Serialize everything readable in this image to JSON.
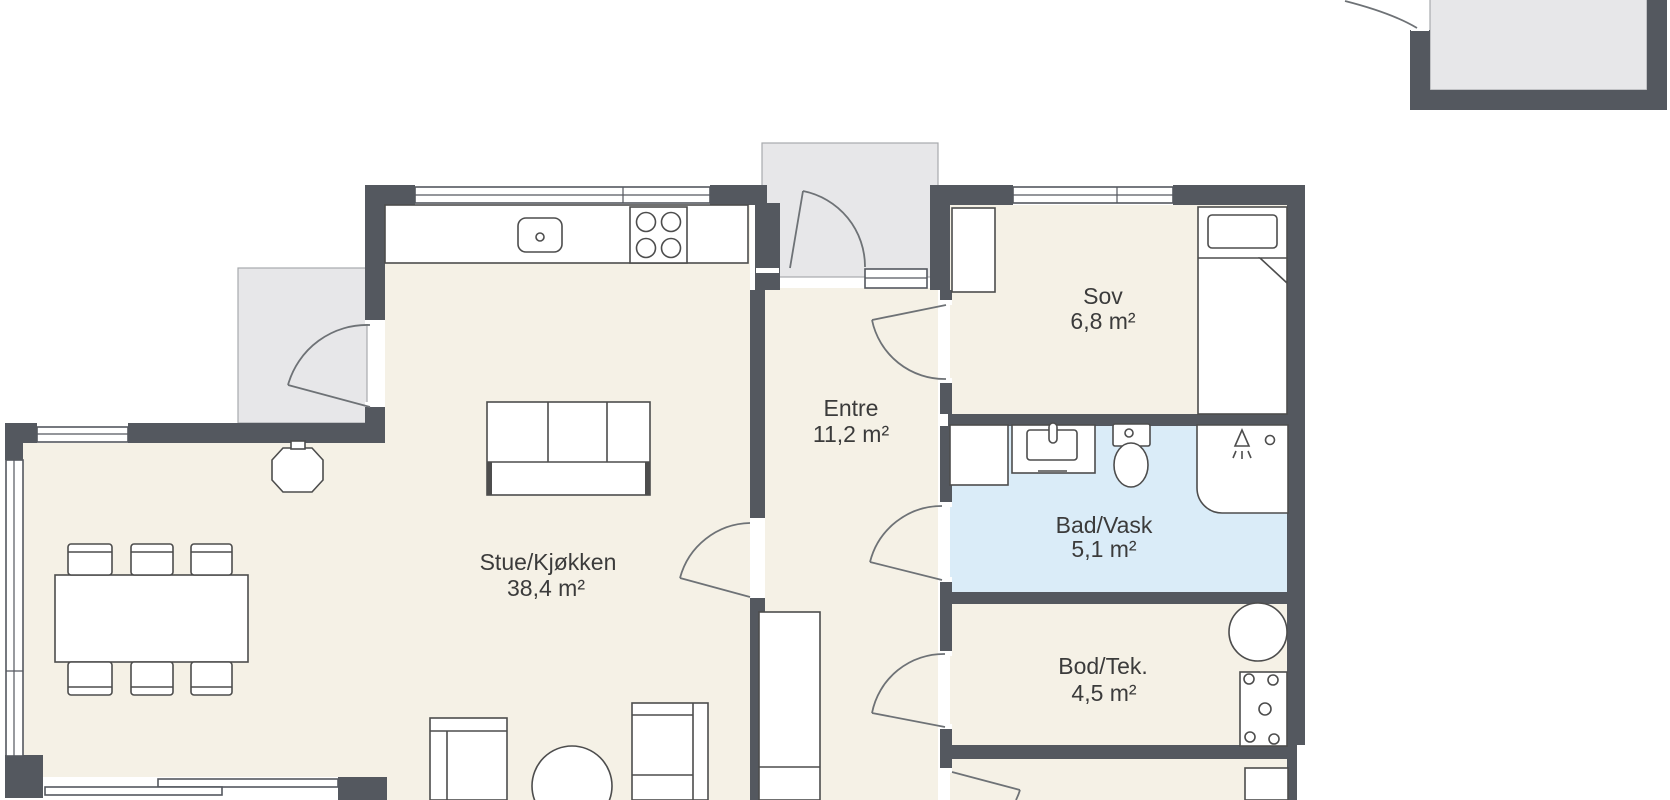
{
  "plan_title": "Floor plan",
  "colors": {
    "background": "#ffffff",
    "wall": "#54585f",
    "floor": "#f5f1e6",
    "bath": "#daecf8",
    "terrace": "#e7e7e9",
    "outline": "#4d4d4d",
    "label": "#3b3b3b"
  },
  "rooms": [
    {
      "id": "stue",
      "name": "Stue/Kjøkken",
      "area": "38,4 m²"
    },
    {
      "id": "entre",
      "name": "Entre",
      "area": "11,2 m²"
    },
    {
      "id": "sov",
      "name": "Sov",
      "area": "6,8 m²"
    },
    {
      "id": "bad",
      "name": "Bad/Vask",
      "area": "5,1 m²"
    },
    {
      "id": "bod",
      "name": "Bod/Tek.",
      "area": "4,5 m²"
    }
  ],
  "fixtures": [
    "kitchen-counter",
    "kitchen-sink",
    "cooktop",
    "fireplace-stove",
    "dining-table",
    "dining-chair",
    "sofa",
    "armchair",
    "round-coffee-table",
    "lounge-sofa",
    "entre-wardrobe",
    "bedroom-wardrobe",
    "bed",
    "bathroom-cabinet",
    "vanity-sink",
    "toilet",
    "shower-cabin",
    "water-heater",
    "electrical-panel",
    "storage-cabinet",
    "sliding-terrace-door",
    "window",
    "door-swing",
    "terrace",
    "entry-porch"
  ]
}
